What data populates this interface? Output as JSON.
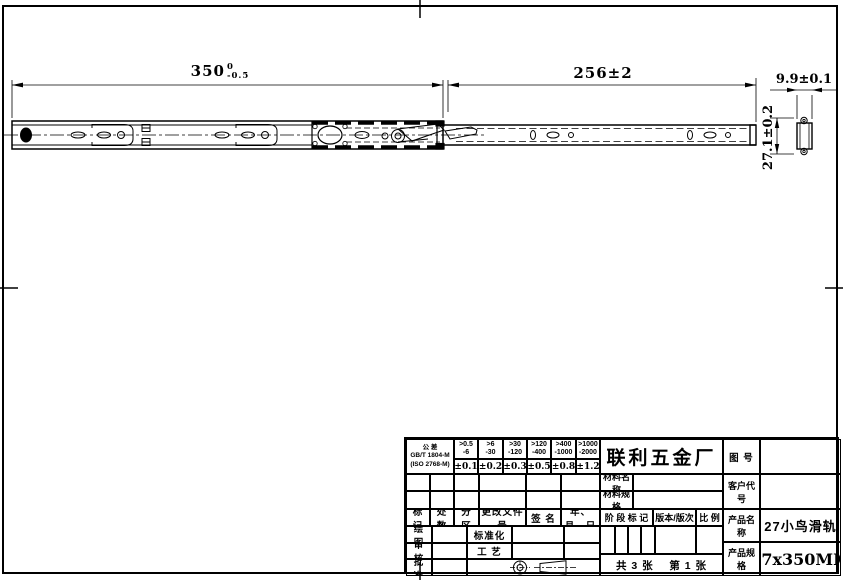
{
  "page": {
    "background": "#ffffff",
    "line_color": "#000000"
  },
  "drawing": {
    "dim_length": {
      "value": "350",
      "tol_upper": "0",
      "tol_lower": "-0.5"
    },
    "dim_travel": "256±2",
    "dim_width": "9.9±0.1",
    "dim_height": "27.1±0.2"
  },
  "title_block": {
    "tolerance_table": {
      "label": {
        "line1": "公 差",
        "line2": "GB/T 1804-M",
        "line3": "(ISO 2768-M)"
      },
      "ranges": [
        {
          "over": ">0.5",
          "to": "-6"
        },
        {
          "over": ">6",
          "to": "-30"
        },
        {
          "over": ">30",
          "to": "-120"
        },
        {
          "over": ">120",
          "to": "-400"
        },
        {
          "over": ">400",
          "to": "-1000"
        },
        {
          "over": ">1000",
          "to": "-2000"
        }
      ],
      "values": [
        "±0.1",
        "±0.2",
        "±0.3",
        "±0.5",
        "±0.8",
        "±1.2"
      ]
    },
    "company": "联利五金厂",
    "labels": {
      "drawing_no": "图  号",
      "customer_code": "客户代号",
      "material_name": "材料名称",
      "material_spec": "材料规格",
      "product_name": "产品名称",
      "product_spec": "产品规格",
      "stage_mark": "阶 段 标 记",
      "version": "版本/版次",
      "scale": "比 例",
      "draw": "绘 图",
      "check": "审 核",
      "approve": "批 准",
      "standardize": "标准化",
      "process": "工 艺"
    },
    "revision_header": [
      "标 记",
      "处 数",
      "分 区",
      "更改文件号",
      "签 名",
      "年、月、日"
    ],
    "product_name": "27小鸟滑轨",
    "product_spec": "27x350MM",
    "sheet_info": "共 3 张    第 1 张"
  }
}
